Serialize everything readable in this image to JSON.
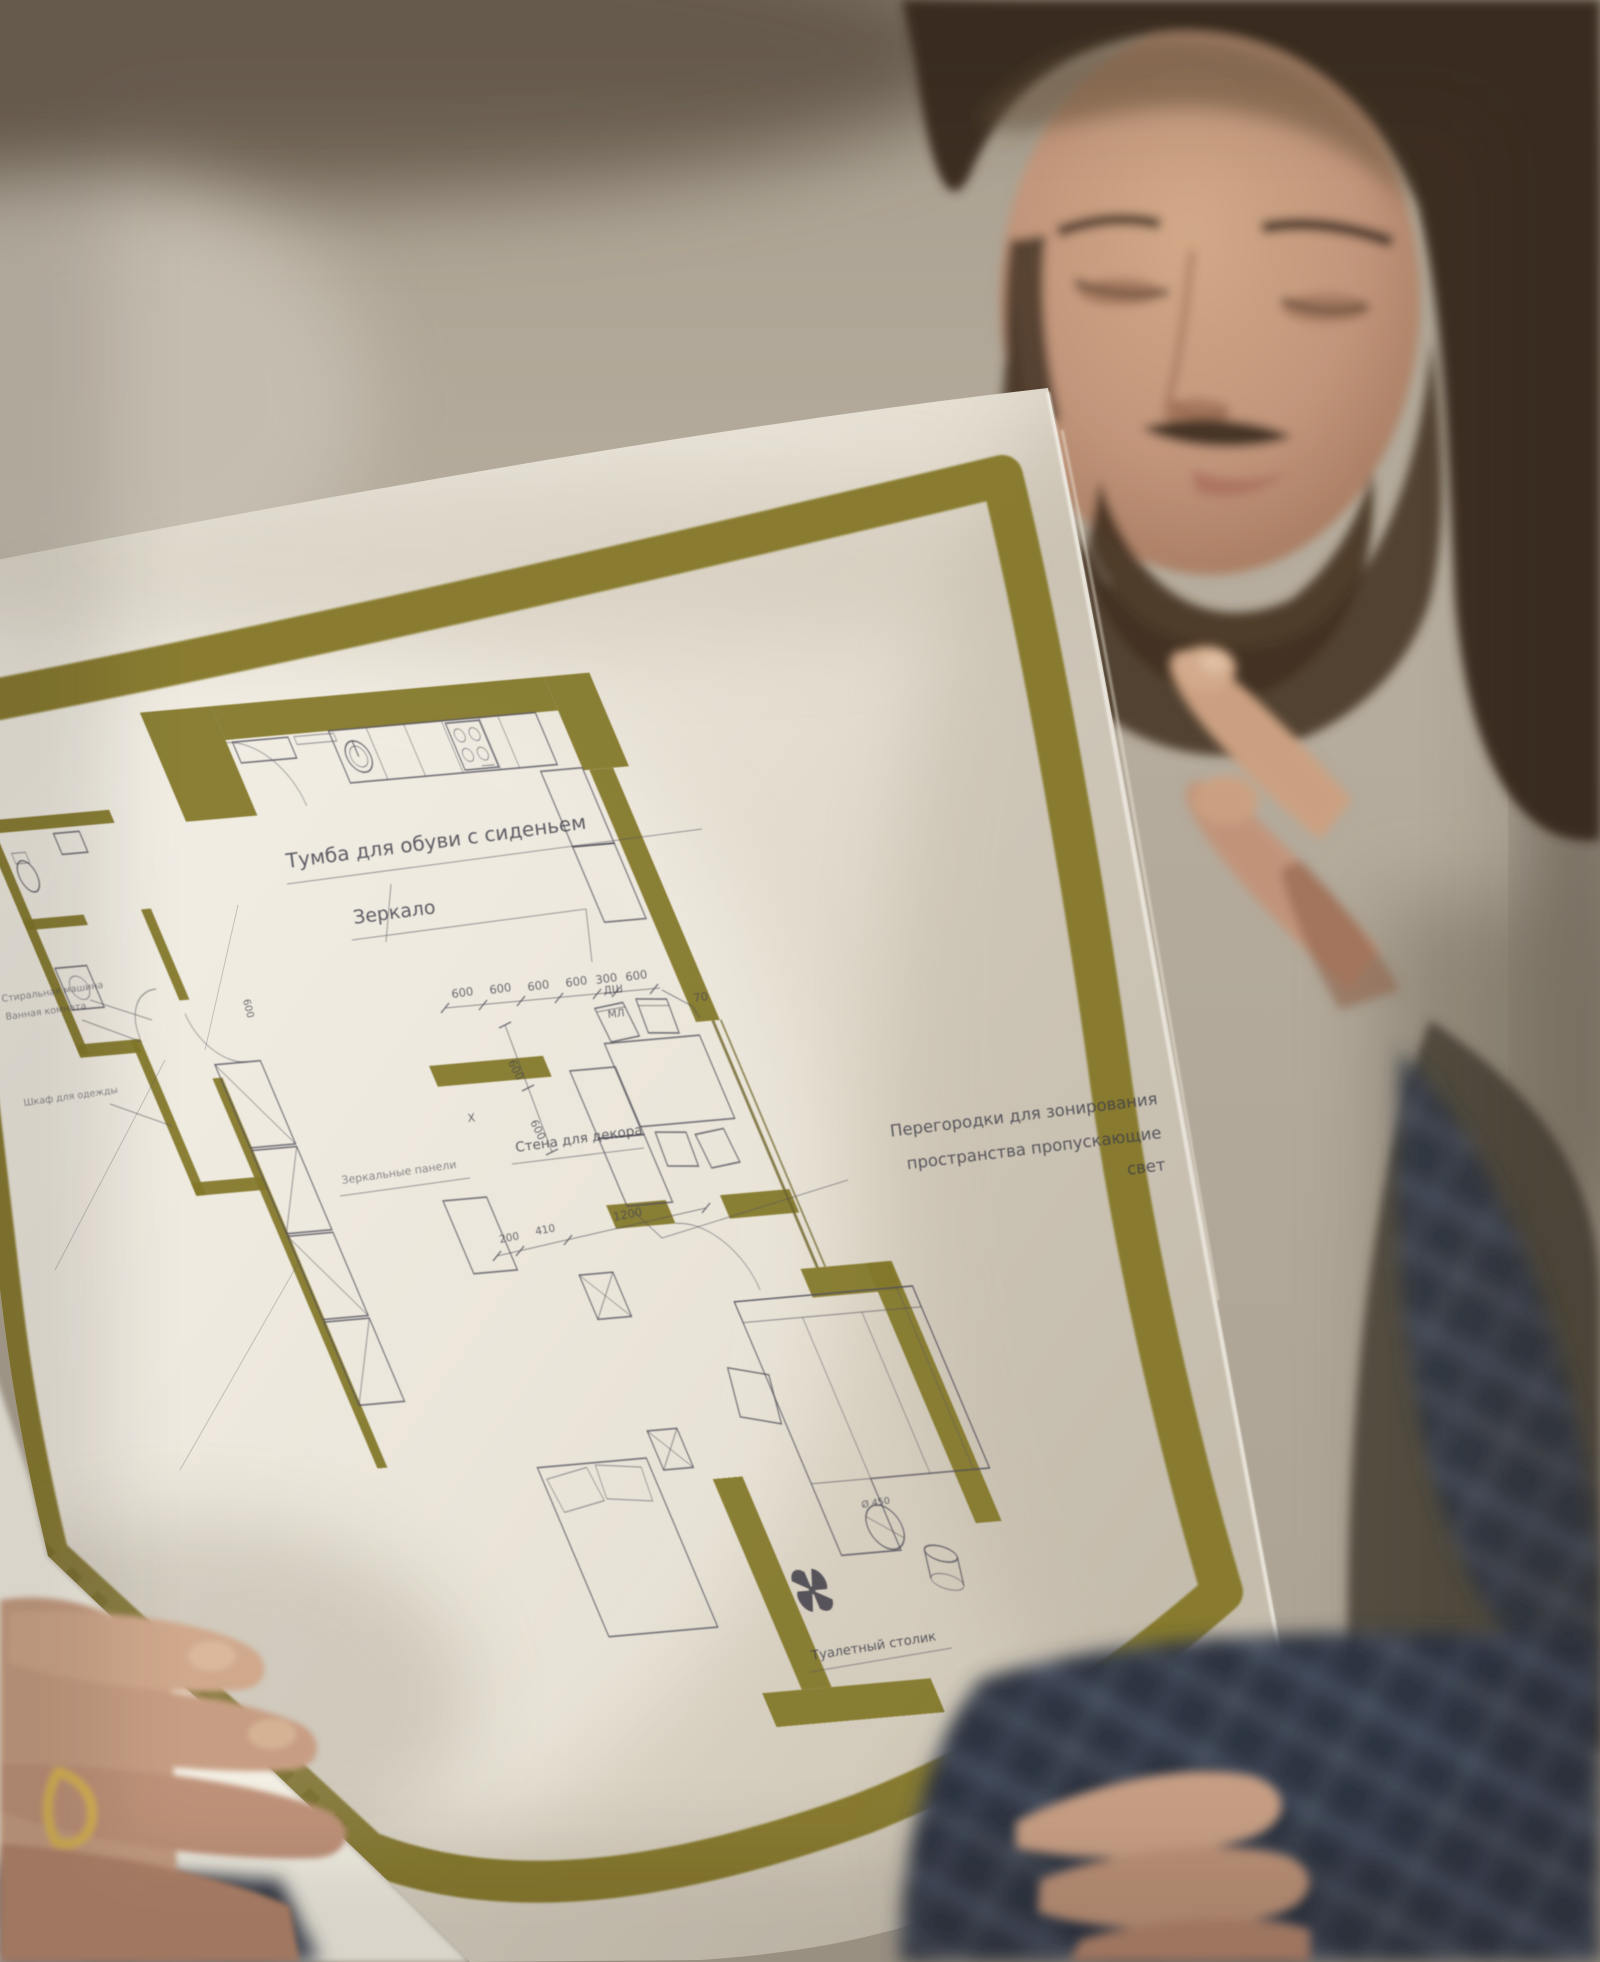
{
  "plan": {
    "labels": {
      "shoe_bench": "Тумба для обуви с сиденьем",
      "mirror": "Зеркало",
      "partition_line1": "Перегородки для зонирования",
      "partition_line2": "пространства пропускающие",
      "partition_line3": "свет",
      "decor_wall": "Стена для декора",
      "dressing_table": "Туалетный столик",
      "washer": "Стиральная машина",
      "bathroom": "Ванная комната",
      "wardrobe": "Шкаф для одежды",
      "mirror_panels": "Зеркальные панели"
    },
    "appliances": {
      "oven": "ДШ",
      "microwave": "МЛ",
      "fridge": "Х"
    },
    "dimensions": {
      "kitchen_chain": [
        "600",
        "600",
        "600",
        "600",
        "300",
        "600"
      ],
      "wall_offset": "70",
      "counter_depth_1": "600",
      "counter_depth_2": "600",
      "annex_width": "600",
      "living_chain": [
        "200",
        "410",
        "1200"
      ],
      "table_diameter": "Ø 450"
    }
  },
  "colors": {
    "border_olive": "#86792b",
    "wall_olive": "#84782c",
    "paper_light": "#f1ede4",
    "paper_dark": "#cdc5b5",
    "ink": "#45444f",
    "background_wall": "#b3aa9b",
    "skin": "#c79e83",
    "hair": "#3c2f23",
    "shirt_plaid": "#2f3642",
    "ring_gold": "#d9b552"
  }
}
